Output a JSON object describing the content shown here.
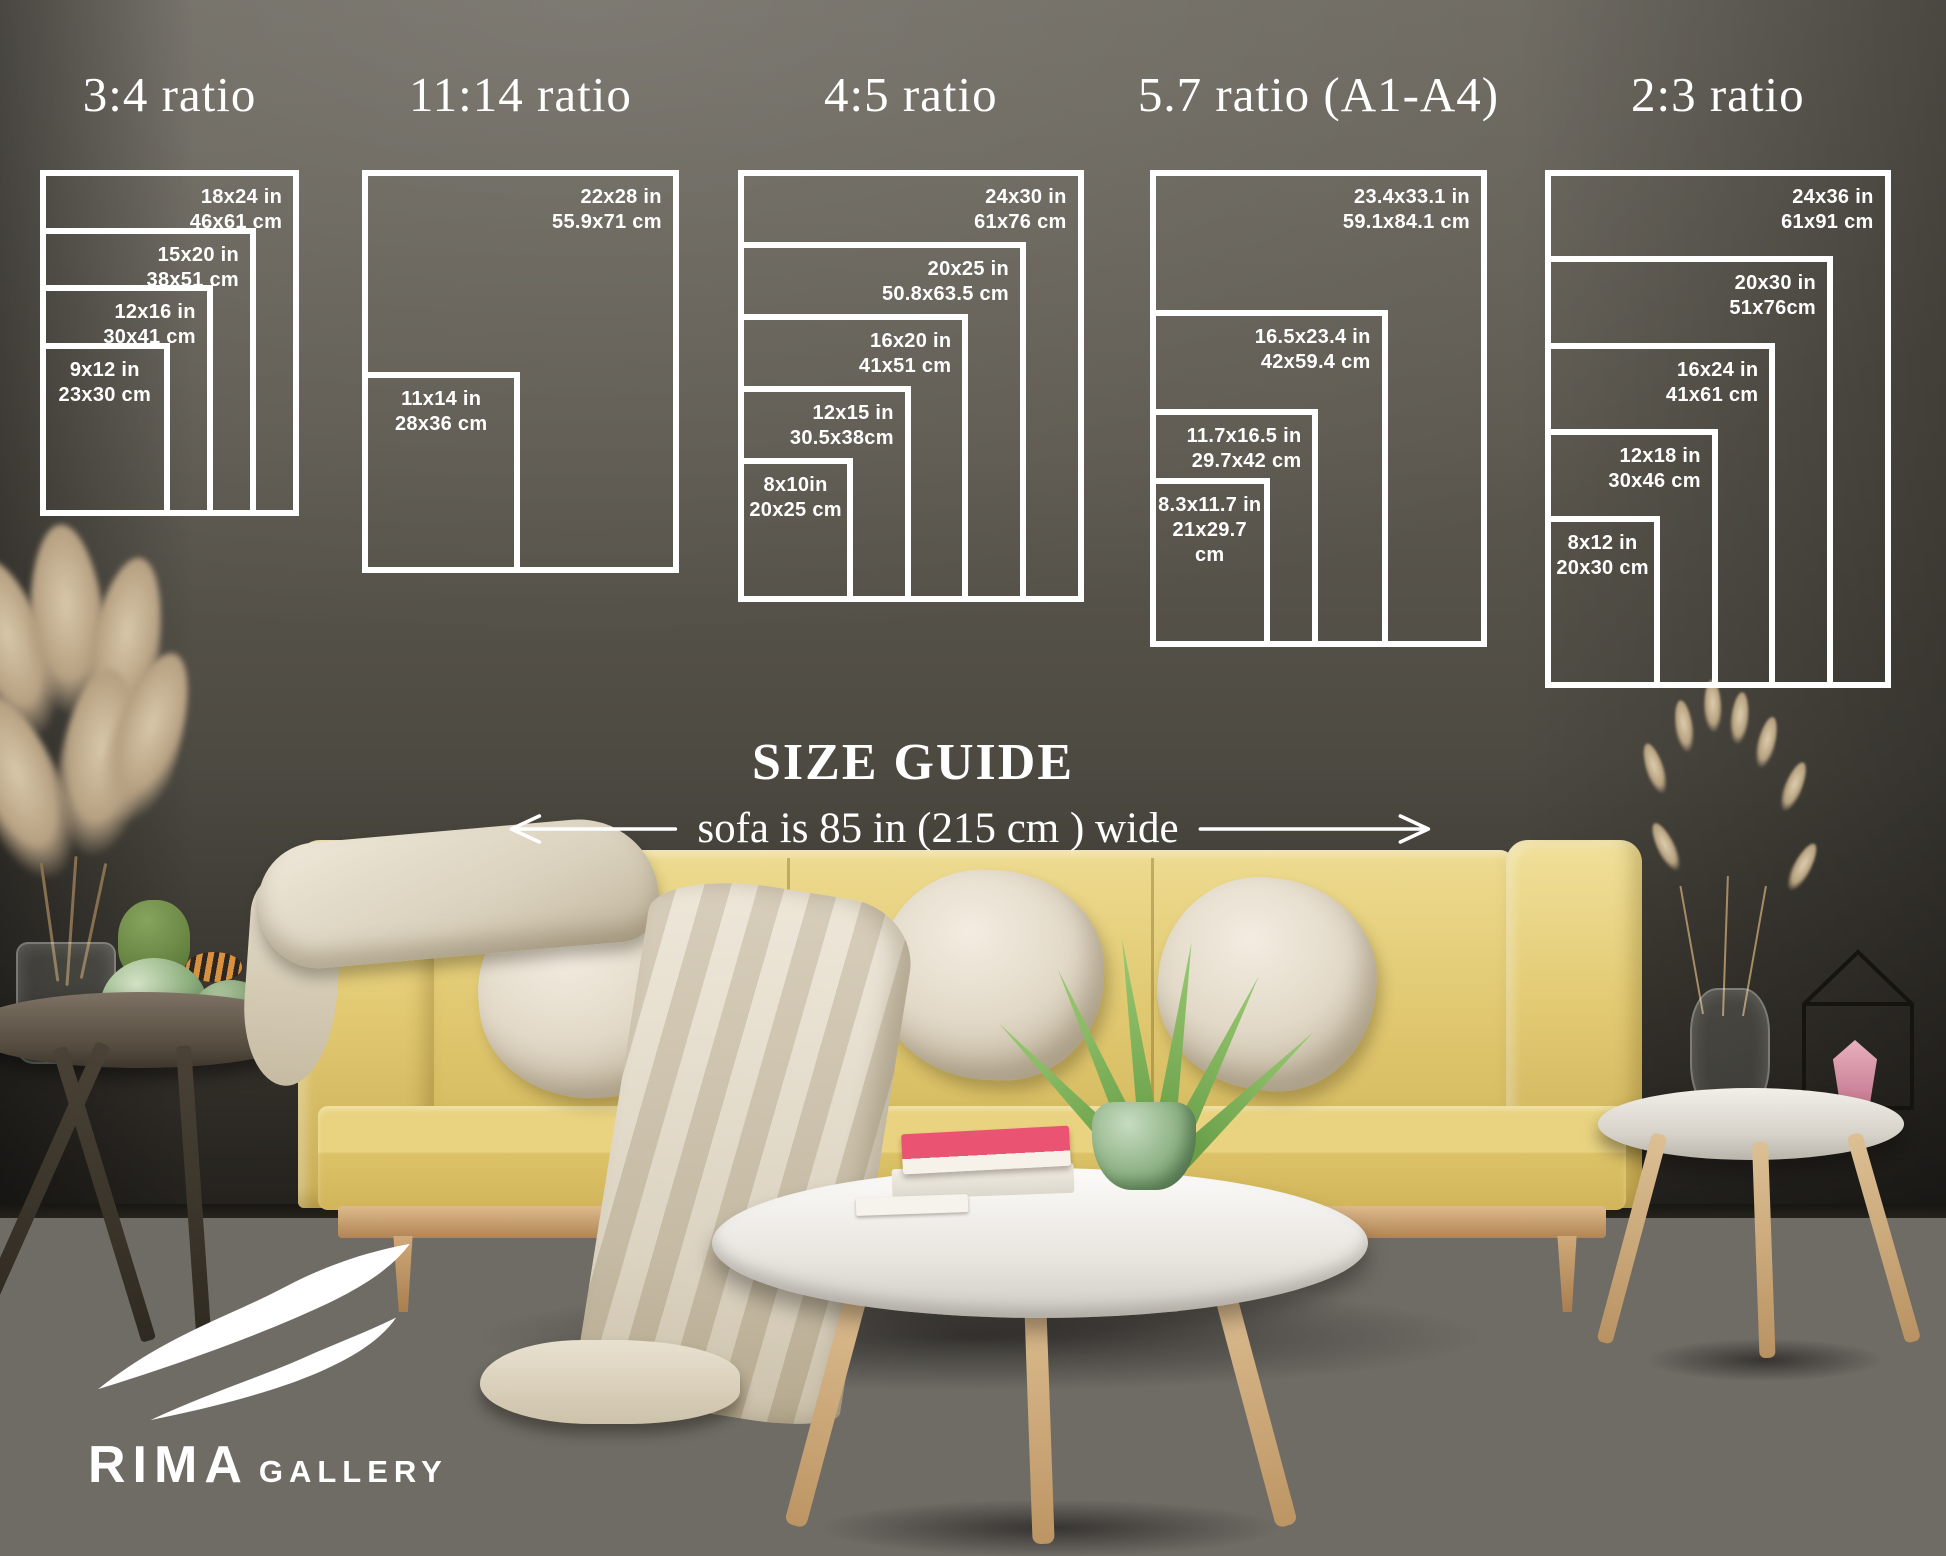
{
  "overlay": {
    "heading": "SIZE GUIDE",
    "sofa_note": "sofa is 85 in (215 cm ) wide",
    "text_color": "#ffffff"
  },
  "size_guide_groups": [
    {
      "title": "3:4 ratio",
      "sizes": [
        {
          "inches": "18x24 in",
          "cm": "46x61 cm"
        },
        {
          "inches": "15x20 in",
          "cm": "38x51 cm"
        },
        {
          "inches": "12x16 in",
          "cm": "30x41 cm"
        },
        {
          "inches": "9x12 in",
          "cm": "23x30 cm"
        }
      ]
    },
    {
      "title": "11:14 ratio",
      "sizes": [
        {
          "inches": "22x28 in",
          "cm": "55.9x71 cm"
        },
        {
          "inches": "11x14 in",
          "cm": "28x36 cm"
        }
      ]
    },
    {
      "title": "4:5 ratio",
      "sizes": [
        {
          "inches": "24x30 in",
          "cm": "61x76 cm"
        },
        {
          "inches": "20x25 in",
          "cm": "50.8x63.5 cm"
        },
        {
          "inches": "16x20 in",
          "cm": "41x51 cm"
        },
        {
          "inches": "12x15 in",
          "cm": "30.5x38cm"
        },
        {
          "inches": "8x10in",
          "cm": "20x25 cm"
        }
      ]
    },
    {
      "title": "5.7 ratio (A1-A4)",
      "sizes": [
        {
          "inches": "23.4x33.1 in",
          "cm": "59.1x84.1 cm"
        },
        {
          "inches": "16.5x23.4 in",
          "cm": "42x59.4 cm"
        },
        {
          "inches": "11.7x16.5 in",
          "cm": "29.7x42 cm"
        },
        {
          "inches": "8.3x11.7 in",
          "cm": "21x29.7 cm"
        }
      ]
    },
    {
      "title": "2:3 ratio",
      "sizes": [
        {
          "inches": "24x36 in",
          "cm": "61x91 cm"
        },
        {
          "inches": "20x30 in",
          "cm": "51x76cm"
        },
        {
          "inches": "16x24 in",
          "cm": "41x61 cm"
        },
        {
          "inches": "12x18 in",
          "cm": "30x46 cm"
        },
        {
          "inches": "8x12 in",
          "cm": "20x30 cm"
        }
      ]
    }
  ],
  "logo": {
    "brand": "RIMA",
    "suffix": "GALLERY"
  },
  "colors": {
    "overlay_text": "#ffffff",
    "wall": "#5c584f",
    "floor": "#6f6c66",
    "sofa_yellow": "#e6cf7e",
    "pillow_cream": "#ece5d8",
    "book_pink": "#ea5472",
    "plant_green": "#7db45e"
  }
}
